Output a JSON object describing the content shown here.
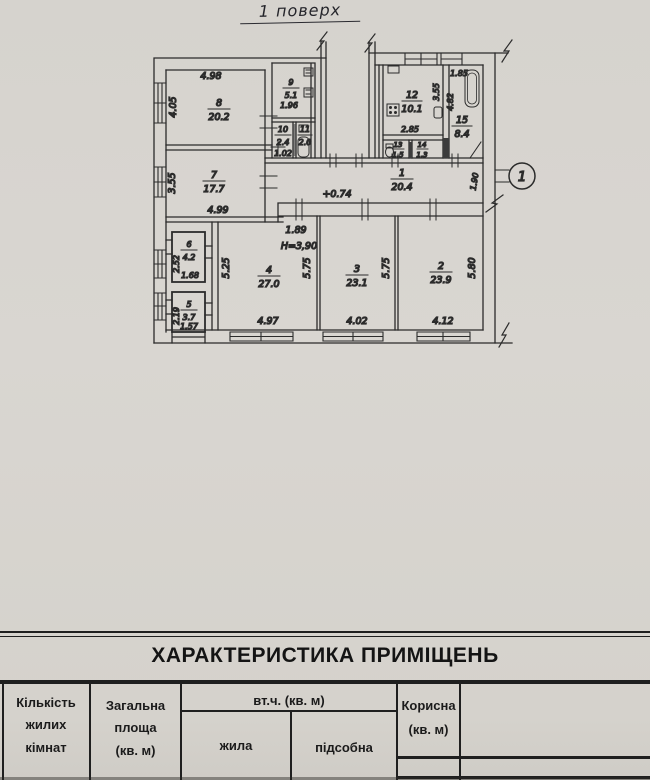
{
  "page_title": "1 поверх",
  "plan": {
    "section_marker": "1",
    "level_mark": "+0.74",
    "height_mark": "Н=3,90",
    "step_dim": "1.89",
    "rooms": {
      "r1": {
        "number": "1",
        "area": "20.4"
      },
      "r2": {
        "number": "2",
        "area": "23.9"
      },
      "r3": {
        "number": "3",
        "area": "23.1"
      },
      "r4": {
        "number": "4",
        "area": "27.0"
      },
      "r5": {
        "number": "5",
        "area": "3.7"
      },
      "r6": {
        "number": "6",
        "area": "4.2"
      },
      "r7": {
        "number": "7",
        "area": "17.7"
      },
      "r8": {
        "number": "8",
        "area": "20.2"
      },
      "r9": {
        "number": "9",
        "area": "5.1"
      },
      "r10": {
        "number": "10",
        "area": "2.4"
      },
      "r11": {
        "number": "11",
        "area": "2.0"
      },
      "r12": {
        "number": "12",
        "area": "10.1"
      },
      "r13": {
        "number": "13",
        "area": "1.5"
      },
      "r14": {
        "number": "14",
        "area": "1.3"
      },
      "r15": {
        "number": "15",
        "area": "8.4"
      }
    },
    "dims": {
      "room8_w": "4.98",
      "room8_h": "4.05",
      "room7_h": "3.55",
      "room7_w": "4.99",
      "room9_w": "1.96",
      "room10_sub": "1.02",
      "room12_w": "2.85",
      "room12_h": "3.55",
      "room15_w": "1.85",
      "room15_h": "4.82",
      "corridor_w": "1.90",
      "room6_h": "2.52",
      "room6_w": "1.68",
      "room5_h": "2.19",
      "room5_w": "1.57",
      "room4_hl": "5.25",
      "room4_hr": "5.75",
      "room4_w": "4.97",
      "room3_hr": "5.75",
      "room3_w": "4.02",
      "room2_hr": "5.80",
      "room2_w": "4.12"
    }
  },
  "table": {
    "title": "ХАРАКТЕРИСТИКА ПРИМІЩЕНЬ",
    "header": {
      "rooms_count": "Кількість\nжилих\nкімнат",
      "total_area": "Загальна\nплоща\n(кв. м)",
      "including": "вт.ч. (кв. м)",
      "living": "жила",
      "auxiliary": "підсобна",
      "useful": "Корисна\n(кв. м)"
    }
  },
  "colors": {
    "paper": "#d7d4cf",
    "ink": "#2b2b2b",
    "table_line": "#1f1f1f"
  }
}
